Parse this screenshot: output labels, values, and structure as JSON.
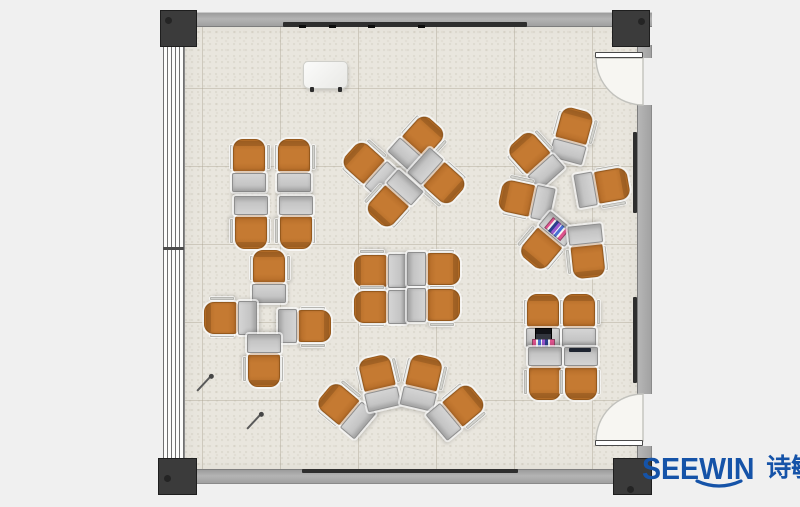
{
  "scene": {
    "width": 800,
    "height": 507,
    "bg": "#f0f0f0"
  },
  "palette": {
    "floor": "#e9e6de",
    "tile_line": "rgba(165,158,140,0.40)",
    "wall": "#a9a9a9",
    "wall_edge": "#7d7d7d",
    "column": "#3b3b3b",
    "column_dot": "#242424",
    "board_strip": "#2e2e2e",
    "door_leaf": "#ffffff",
    "door_leaf_edge": "#4a4a4a",
    "door_arc_fill": "#f7f6f2",
    "door_arc_stroke": "#c2c2bd",
    "chair": "#c57a32",
    "chair_dark": "#96591c",
    "chair_back": "#b06a26",
    "desk": "#bdbdbd",
    "desk_light": "#d4d4d4",
    "desk_edge": "#8f8f8f",
    "halo": "rgba(255,255,255,0.68)",
    "logo_blue": "#1553a8"
  },
  "room": {
    "floor": {
      "x": 185,
      "y": 25,
      "w": 452,
      "h": 444
    },
    "top_wall": {
      "x": 163,
      "y": 12,
      "w": 489,
      "h": 13
    },
    "bottom_wall": {
      "x": 163,
      "y": 469,
      "w": 450,
      "h": 13
    },
    "window_wall": {
      "x": 163,
      "y": 12,
      "w": 21,
      "h": 480
    },
    "window_tick": {
      "x": 163,
      "y": 247,
      "w": 21,
      "h": 3
    },
    "right_wall_upper_stub": {
      "x": 637,
      "y": 45,
      "w": 13,
      "h": 13
    },
    "right_wall_mid": {
      "x": 637,
      "y": 105,
      "w": 13,
      "h": 289
    },
    "right_wall_lower_stub": {
      "x": 637,
      "y": 446,
      "w": 13,
      "h": 23
    },
    "top_board": {
      "x": 283,
      "y": 22,
      "w": 244,
      "h": 5
    },
    "top_board_marks": [
      299,
      329,
      368,
      418
    ],
    "bottom_board": {
      "x": 302,
      "y": 469,
      "w": 216,
      "h": 4
    },
    "right_boards": [
      {
        "x": 633,
        "y": 132,
        "w": 4,
        "h": 81
      },
      {
        "x": 633,
        "y": 297,
        "w": 4,
        "h": 86
      }
    ],
    "columns": [
      {
        "x": 160,
        "y": 10,
        "w": 37,
        "h": 37,
        "dot": {
          "dx": 4,
          "dy": 6
        }
      },
      {
        "x": 612,
        "y": 10,
        "w": 38,
        "h": 37,
        "dot": {
          "dx": 25,
          "dy": 7
        }
      },
      {
        "x": 158,
        "y": 458,
        "w": 39,
        "h": 37,
        "dot": {
          "dx": 5,
          "dy": 16
        }
      },
      {
        "x": 613,
        "y": 458,
        "w": 39,
        "h": 37,
        "dot": {
          "dx": 13,
          "dy": 27
        }
      }
    ],
    "doors": [
      {
        "name": "top-right-door",
        "leaf": {
          "x": 595,
          "y": 52,
          "w": 48,
          "h": 6
        },
        "arc": "M 596 58 A 47 47 0 0 0 643 105 L 643 58 Z"
      },
      {
        "name": "bottom-right-door",
        "leaf": {
          "x": 595,
          "y": 440,
          "w": 48,
          "h": 6
        },
        "arc": "M 596 441 A 47 47 0 0 1 643 394 L 643 441 Z"
      }
    ]
  },
  "furniture": {
    "unit_size": {
      "w": 36,
      "h": 54
    },
    "units": [
      {
        "cluster": "top-left-pod",
        "x": 250,
        "y": 166,
        "r": 0
      },
      {
        "cluster": "top-left-pod",
        "x": 295,
        "y": 166,
        "r": 0
      },
      {
        "cluster": "top-left-pod",
        "x": 250,
        "y": 222,
        "r": 180
      },
      {
        "cluster": "top-left-pod",
        "x": 295,
        "y": 222,
        "r": 180
      },
      {
        "cluster": "diagonal-pod",
        "x": 418,
        "y": 144,
        "r": 42
      },
      {
        "cluster": "diagonal-pod",
        "x": 371,
        "y": 168,
        "r": -48
      },
      {
        "cluster": "diagonal-pod",
        "x": 437,
        "y": 178,
        "r": 132
      },
      {
        "cluster": "diagonal-pod",
        "x": 393,
        "y": 199,
        "r": 222
      },
      {
        "cluster": "center-pod",
        "x": 381,
        "y": 270,
        "r": -90
      },
      {
        "cluster": "center-pod",
        "x": 433,
        "y": 270,
        "r": 90
      },
      {
        "cluster": "center-pod",
        "x": 381,
        "y": 306,
        "r": -90
      },
      {
        "cluster": "center-pod",
        "x": 433,
        "y": 306,
        "r": 90
      },
      {
        "cluster": "cross-pod",
        "x": 270,
        "y": 277,
        "r": 0
      },
      {
        "cluster": "cross-pod",
        "x": 231,
        "y": 317,
        "r": -90
      },
      {
        "cluster": "cross-pod",
        "x": 304,
        "y": 327,
        "r": 90
      },
      {
        "cluster": "cross-pod",
        "x": 263,
        "y": 360,
        "r": 180
      },
      {
        "cluster": "fan-pod",
        "x": 346,
        "y": 409,
        "r": -50
      },
      {
        "cluster": "fan-pod",
        "x": 380,
        "y": 383,
        "r": -13
      },
      {
        "cluster": "fan-pod",
        "x": 423,
        "y": 383,
        "r": 13
      },
      {
        "cluster": "fan-pod",
        "x": 457,
        "y": 412,
        "r": 50
      },
      {
        "cluster": "circle-pod",
        "x": 573,
        "y": 136,
        "r": 15
      },
      {
        "cluster": "circle-pod",
        "x": 536,
        "y": 159,
        "r": -42
      },
      {
        "cluster": "circle-pod",
        "x": 527,
        "y": 199,
        "r": -78
      },
      {
        "cluster": "circle-pod",
        "x": 546,
        "y": 241,
        "r": -140,
        "items": [
          {
            "type": "books",
            "x": 7,
            "y": 36,
            "w": 21,
            "h": 14
          }
        ]
      },
      {
        "cluster": "circle-pod",
        "x": 586,
        "y": 251,
        "r": 174
      },
      {
        "cluster": "circle-pod",
        "x": 602,
        "y": 188,
        "r": 80
      },
      {
        "cluster": "bottom-right-pod",
        "x": 544,
        "y": 321,
        "r": 0,
        "items": [
          {
            "type": "laptop",
            "x": 9,
            "y": 34,
            "w": 17,
            "h": 12
          },
          {
            "type": "books",
            "x": 6,
            "y": 45,
            "w": 23,
            "h": 8
          }
        ]
      },
      {
        "cluster": "bottom-right-pod",
        "x": 580,
        "y": 321,
        "r": 0
      },
      {
        "cluster": "bottom-right-pod",
        "x": 544,
        "y": 373,
        "r": 180
      },
      {
        "cluster": "bottom-right-pod",
        "x": 580,
        "y": 373,
        "r": 180,
        "items": [
          {
            "type": "tablet",
            "x": 7,
            "y": 48,
            "w": 22,
            "h": 4
          }
        ]
      }
    ]
  },
  "props": {
    "whiteboard": {
      "x": 303,
      "y": 61,
      "w": 43,
      "h": 26
    },
    "pens": [
      {
        "x": 197,
        "y": 390,
        "len": 21,
        "angle": -47
      },
      {
        "x": 247,
        "y": 428,
        "len": 21,
        "angle": -47
      }
    ]
  },
  "logo": {
    "brand": "SEEWIN",
    "cjk": "诗敏"
  }
}
